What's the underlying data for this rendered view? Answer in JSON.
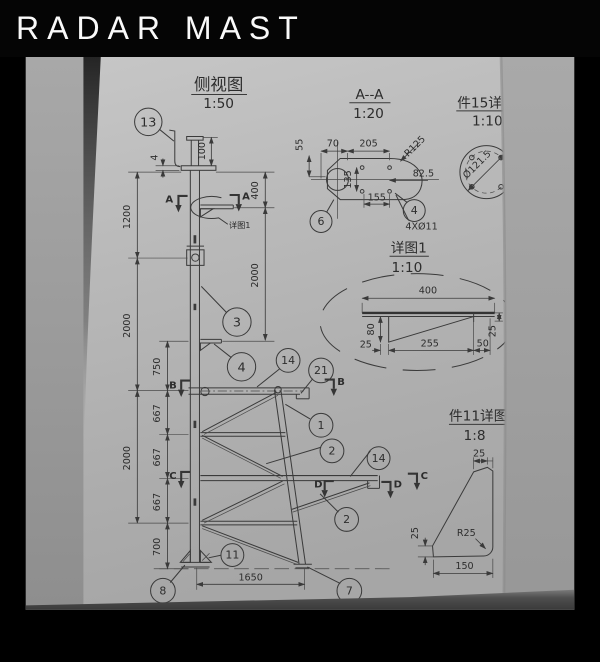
{
  "header": {
    "title": "RADAR MAST"
  },
  "colors": {
    "header_bg": "#050505",
    "header_text": "#fafafa",
    "paper": "#b7b7b7",
    "line": "#3a3a3a"
  },
  "side_view": {
    "title": "侧视图",
    "scale": "1:50",
    "detail_label": "详图1",
    "dims": {
      "h100": "100",
      "t4": "4",
      "v1200": "1200",
      "v400": "400",
      "v2000a": "2000",
      "v2000b": "2000",
      "v2000c": "2000",
      "v750": "750",
      "v667a": "667",
      "v667b": "667",
      "v667c": "667",
      "v700": "700",
      "w1650": "1650"
    },
    "sections": {
      "a": "A",
      "b": "B",
      "c": "C",
      "d": "D"
    }
  },
  "section_aa": {
    "title": "A--A",
    "scale": "1:20",
    "dims": {
      "d55": "55",
      "d70": "70",
      "d205": "205",
      "r125": "R125",
      "d825": "82.5",
      "d135": "135",
      "d155": "155",
      "holes": "4XØ11"
    }
  },
  "part15": {
    "title": "件15详图",
    "scale": "1:10",
    "dims": {
      "dia": "Ø121.5"
    }
  },
  "detail1": {
    "title": "详图1",
    "scale": "1:10",
    "dims": {
      "d400": "400",
      "d80": "80",
      "d25a": "25",
      "d255": "255",
      "d50": "50",
      "d25b": "25"
    }
  },
  "part11": {
    "title": "件11详图",
    "scale": "1:8",
    "dims": {
      "d25top": "25",
      "d25left": "25",
      "r25": "R25",
      "d150": "150"
    }
  },
  "balloons": {
    "n13": "13",
    "n3": "3",
    "n4a": "4",
    "n14a": "14",
    "n21": "21",
    "n1": "1",
    "n2a": "2",
    "n14b": "14",
    "n2b": "2",
    "n11": "11",
    "n8": "8",
    "n7": "7",
    "n6": "6",
    "n4b": "4"
  }
}
